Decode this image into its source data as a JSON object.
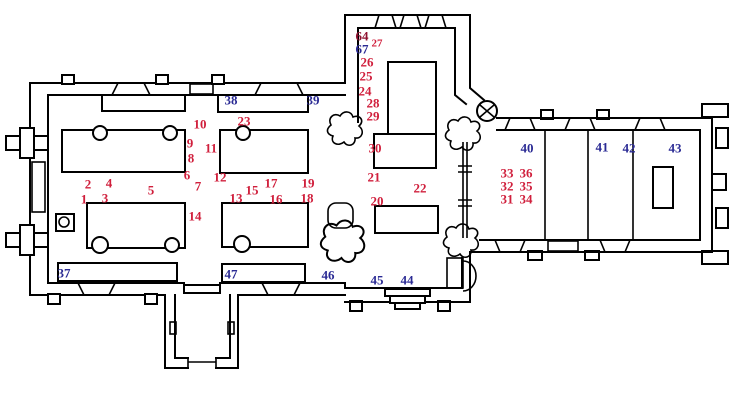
{
  "colors": {
    "wall": "#000000",
    "background": "#ffffff",
    "red_marker": "#d01f3c",
    "blue_marker": "#2a2a94",
    "dark_red_marker": "#8f1130"
  },
  "markers": [
    {
      "label": "1",
      "x": 84,
      "y": 199,
      "color": "red"
    },
    {
      "label": "2",
      "x": 88,
      "y": 184,
      "color": "red"
    },
    {
      "label": "3",
      "x": 105,
      "y": 198,
      "color": "red"
    },
    {
      "label": "4",
      "x": 109,
      "y": 183,
      "color": "red"
    },
    {
      "label": "5",
      "x": 151,
      "y": 190,
      "color": "red"
    },
    {
      "label": "6",
      "x": 187,
      "y": 175,
      "color": "red"
    },
    {
      "label": "7",
      "x": 198,
      "y": 186,
      "color": "red"
    },
    {
      "label": "8",
      "x": 191,
      "y": 158,
      "color": "red"
    },
    {
      "label": "9",
      "x": 190,
      "y": 143,
      "color": "red"
    },
    {
      "label": "10",
      "x": 200,
      "y": 124,
      "color": "red"
    },
    {
      "label": "11",
      "x": 211,
      "y": 148,
      "color": "red"
    },
    {
      "label": "12",
      "x": 220,
      "y": 177,
      "color": "red"
    },
    {
      "label": "13",
      "x": 236,
      "y": 198,
      "color": "red"
    },
    {
      "label": "14",
      "x": 195,
      "y": 216,
      "color": "red"
    },
    {
      "label": "15",
      "x": 252,
      "y": 190,
      "color": "red"
    },
    {
      "label": "16",
      "x": 276,
      "y": 199,
      "color": "red"
    },
    {
      "label": "17",
      "x": 271,
      "y": 183,
      "color": "red"
    },
    {
      "label": "18",
      "x": 307,
      "y": 198,
      "color": "red"
    },
    {
      "label": "19",
      "x": 308,
      "y": 183,
      "color": "red"
    },
    {
      "label": "20",
      "x": 377,
      "y": 201,
      "color": "red"
    },
    {
      "label": "21",
      "x": 374,
      "y": 177,
      "color": "red"
    },
    {
      "label": "22",
      "x": 420,
      "y": 188,
      "color": "red"
    },
    {
      "label": "23",
      "x": 244,
      "y": 121,
      "color": "red"
    },
    {
      "label": "24",
      "x": 365,
      "y": 91,
      "color": "red"
    },
    {
      "label": "25",
      "x": 366,
      "y": 76,
      "color": "red"
    },
    {
      "label": "26",
      "x": 367,
      "y": 62,
      "color": "red"
    },
    {
      "label": "27",
      "x": 377,
      "y": 44,
      "color": "red",
      "size": 11
    },
    {
      "label": "28",
      "x": 373,
      "y": 103,
      "color": "red"
    },
    {
      "label": "29",
      "x": 373,
      "y": 116,
      "color": "red"
    },
    {
      "label": "30",
      "x": 375,
      "y": 148,
      "color": "red"
    },
    {
      "label": "31",
      "x": 507,
      "y": 199,
      "color": "red"
    },
    {
      "label": "32",
      "x": 507,
      "y": 186,
      "color": "red"
    },
    {
      "label": "33",
      "x": 507,
      "y": 173,
      "color": "red"
    },
    {
      "label": "34",
      "x": 526,
      "y": 199,
      "color": "red"
    },
    {
      "label": "35",
      "x": 526,
      "y": 186,
      "color": "red"
    },
    {
      "label": "36",
      "x": 526,
      "y": 173,
      "color": "red"
    },
    {
      "label": "64",
      "x": 362,
      "y": 36,
      "color": "dark_red"
    },
    {
      "label": "37",
      "x": 64,
      "y": 273,
      "color": "blue"
    },
    {
      "label": "38",
      "x": 231,
      "y": 100,
      "color": "blue"
    },
    {
      "label": "39",
      "x": 313,
      "y": 100,
      "color": "blue"
    },
    {
      "label": "40",
      "x": 527,
      "y": 148,
      "color": "blue"
    },
    {
      "label": "41",
      "x": 602,
      "y": 147,
      "color": "blue"
    },
    {
      "label": "42",
      "x": 629,
      "y": 148,
      "color": "blue"
    },
    {
      "label": "43",
      "x": 675,
      "y": 148,
      "color": "blue"
    },
    {
      "label": "44",
      "x": 407,
      "y": 280,
      "color": "blue"
    },
    {
      "label": "45",
      "x": 377,
      "y": 280,
      "color": "blue"
    },
    {
      "label": "46",
      "x": 328,
      "y": 275,
      "color": "blue"
    },
    {
      "label": "47",
      "x": 231,
      "y": 274,
      "color": "blue"
    },
    {
      "label": "67",
      "x": 362,
      "y": 49,
      "color": "blue"
    }
  ]
}
